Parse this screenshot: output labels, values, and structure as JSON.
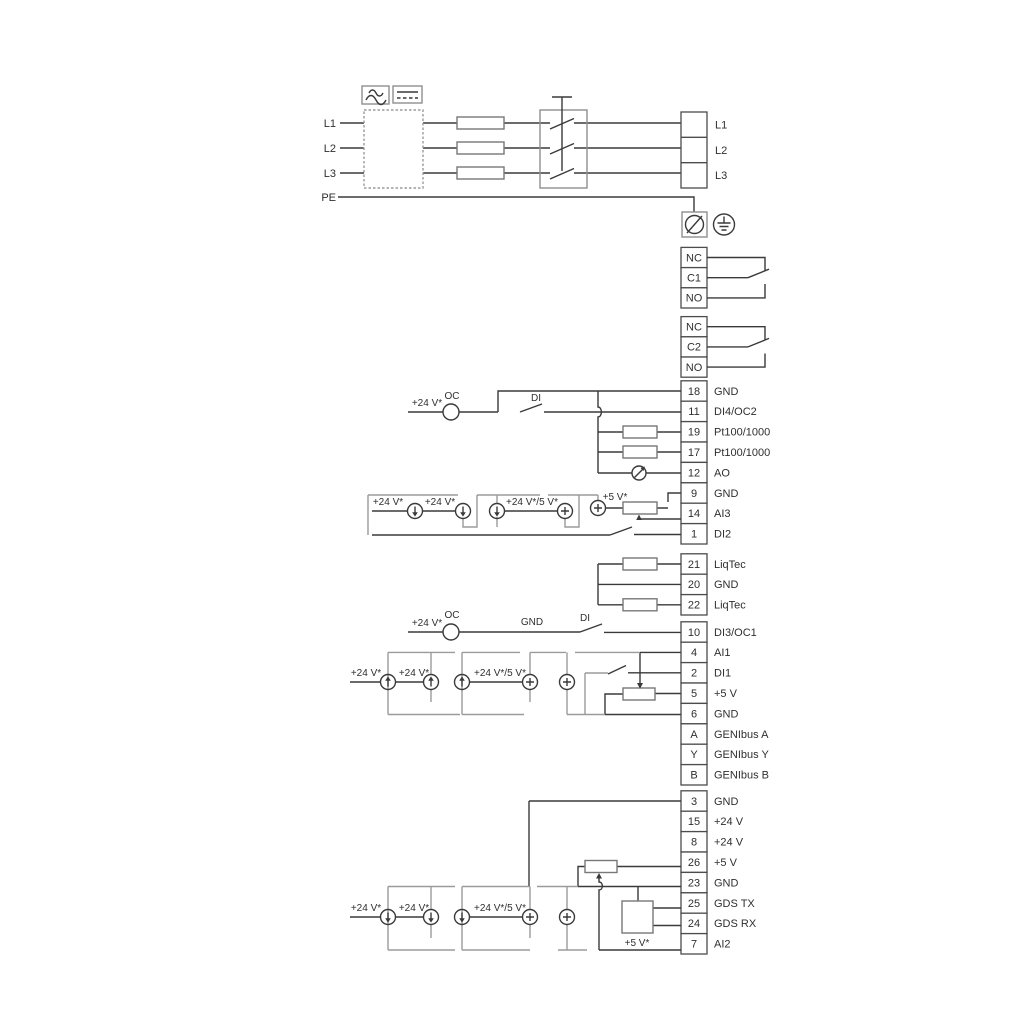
{
  "colors": {
    "wire": "#3a3a3a",
    "bracket": "#9b9b9b",
    "frame": "#8f8f8f",
    "text": "#2f2f2f"
  },
  "terminals": {
    "left_inputs": [
      "L1",
      "L2",
      "L3",
      "PE"
    ],
    "outputs": [
      "L1",
      "L2",
      "L3"
    ],
    "relay1": [
      "NC",
      "C1",
      "NO"
    ],
    "relay2": [
      "NC",
      "C2",
      "NO"
    ],
    "group1": [
      {
        "num": "18",
        "label": "GND"
      },
      {
        "num": "11",
        "label": "DI4/OC2"
      },
      {
        "num": "19",
        "label": "Pt100/1000"
      },
      {
        "num": "17",
        "label": "Pt100/1000"
      },
      {
        "num": "12",
        "label": "AO"
      },
      {
        "num": "9",
        "label": "GND"
      },
      {
        "num": "14",
        "label": "AI3"
      },
      {
        "num": "1",
        "label": "DI2"
      }
    ],
    "group2": [
      {
        "num": "21",
        "label": "LiqTec"
      },
      {
        "num": "20",
        "label": "GND"
      },
      {
        "num": "22",
        "label": "LiqTec"
      }
    ],
    "group3": [
      {
        "num": "10",
        "label": "DI3/OC1"
      },
      {
        "num": "4",
        "label": "AI1"
      },
      {
        "num": "2",
        "label": "DI1"
      },
      {
        "num": "5",
        "label": "+5 V"
      },
      {
        "num": "6",
        "label": "GND"
      },
      {
        "num": "A",
        "label": "GENIbus A"
      },
      {
        "num": "Y",
        "label": "GENIbus Y"
      },
      {
        "num": "B",
        "label": "GENIbus B"
      }
    ],
    "group4": [
      {
        "num": "3",
        "label": "GND"
      },
      {
        "num": "15",
        "label": "+24 V"
      },
      {
        "num": "8",
        "label": "+24 V"
      },
      {
        "num": "26",
        "label": "+5 V"
      },
      {
        "num": "23",
        "label": "GND"
      },
      {
        "num": "25",
        "label": "GDS TX"
      },
      {
        "num": "24",
        "label": "GDS RX"
      },
      {
        "num": "7",
        "label": "AI2"
      }
    ]
  },
  "labels": {
    "s1": {
      "v24": "+24 V*",
      "oc": "OC",
      "di": "DI",
      "src1": "+24 V*",
      "src2": "+24 V*",
      "src45": "+24 V*/5 V*",
      "v5": "+5 V*"
    },
    "s2": {
      "v24": "+24 V*",
      "oc": "OC",
      "gnd": "GND",
      "di": "DI",
      "src1": "+24 V*",
      "src2": "+24 V*",
      "src45": "+24 V*/5 V*"
    },
    "s3": {
      "src1": "+24 V*",
      "src2": "+24 V*",
      "src45": "+24 V*/5 V*",
      "v5": "+5 V*"
    }
  }
}
